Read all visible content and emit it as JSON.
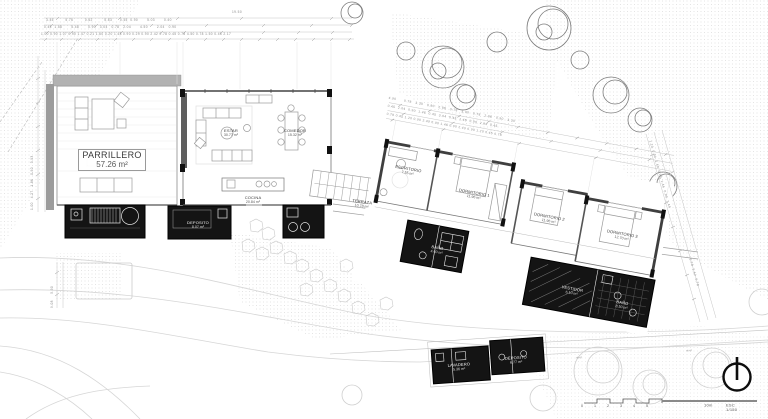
{
  "meta": {
    "scale_label": "ESC 1/150",
    "scale_end_label": "10m",
    "scale_ticks": [
      "0",
      "1",
      "2",
      "3",
      "4",
      "5"
    ]
  },
  "colors": {
    "paper": "#ffffff",
    "ink": "#3f3f3f",
    "light_line": "#c9c9c9",
    "black_fill": "#141414",
    "wall_gray": "#a8a8a8",
    "text": "#3a3a3a"
  },
  "rooms": [
    {
      "name": "PARRILLERO",
      "area": "57.26 m²"
    },
    {
      "name": "ESTAR",
      "area": "30.77 m²"
    },
    {
      "name": "COMEDOR",
      "area": "15.32 m²"
    },
    {
      "name": "COCINA",
      "area": "20.84 m²"
    },
    {
      "name": "TERRAZA",
      "area": "10.78 m²"
    },
    {
      "name": "ESCRITORIO",
      "area": "7.55 m²"
    },
    {
      "name": "DORMITORIO 1",
      "area": "11.96 m²"
    },
    {
      "name": "DORMITORIO 2",
      "area": "11.96 m²"
    },
    {
      "name": "DORMITORIO 3",
      "area": "12.70 m²"
    },
    {
      "name": "DEPOSITO",
      "area": "8.07 m²"
    },
    {
      "name": "BAÑO",
      "area": "4.60 m²"
    },
    {
      "name": "VESTIDOR",
      "area": "6.10 m²"
    },
    {
      "name": "BAÑO",
      "area": "8.50 m²"
    },
    {
      "name": "LAVADERO",
      "area": "5.36 m²"
    },
    {
      "name": "DEPOSITO",
      "area": "6.77 m²"
    }
  ],
  "dimensions": {
    "top_total": "19.50",
    "top_row_1": "3.45         5.76         0.62         5.83      0.45  0.90       5.03       0.40",
    "top_row_2": "0.45  1.58       5.48       0.90   3.04   0.78   2.04       4.50       2.04   0.90",
    "top_row_3": "1.00 0.90 1.07 0.90 1.47 0.21 1.60 0.20 1.48 0.90 0.29 0.90 2.42 0.78 0.45 0.78 4.50 0.78 1.50 0.45 2.17",
    "left_chain": "1.00   4.27   1.86   0.90   3.93",
    "bottom_left_chain": "9.08     5.90",
    "wing_row_1": "4.90      0.78   3.30   0.90   2.86   0.78   3.90   0.78   2.86   0.90   3.30",
    "wing_row_2": "0.45  2.04  0.90  1.46  0.45  3.04  0.45  1.46  0.90  2.04  0.45",
    "wing_row_3": "0.78 0.45 1.20 0.90 2.49 0.90 1.46 0.90 2.49 0.90 1.20 0.45 0.78",
    "right_chain_1": "1.20  0.90  2.49  0.90  1.46  0.90  2.49",
    "right_chain_2": "0.78  2.42  0.78"
  },
  "annotations": {
    "contour": "nivel"
  }
}
